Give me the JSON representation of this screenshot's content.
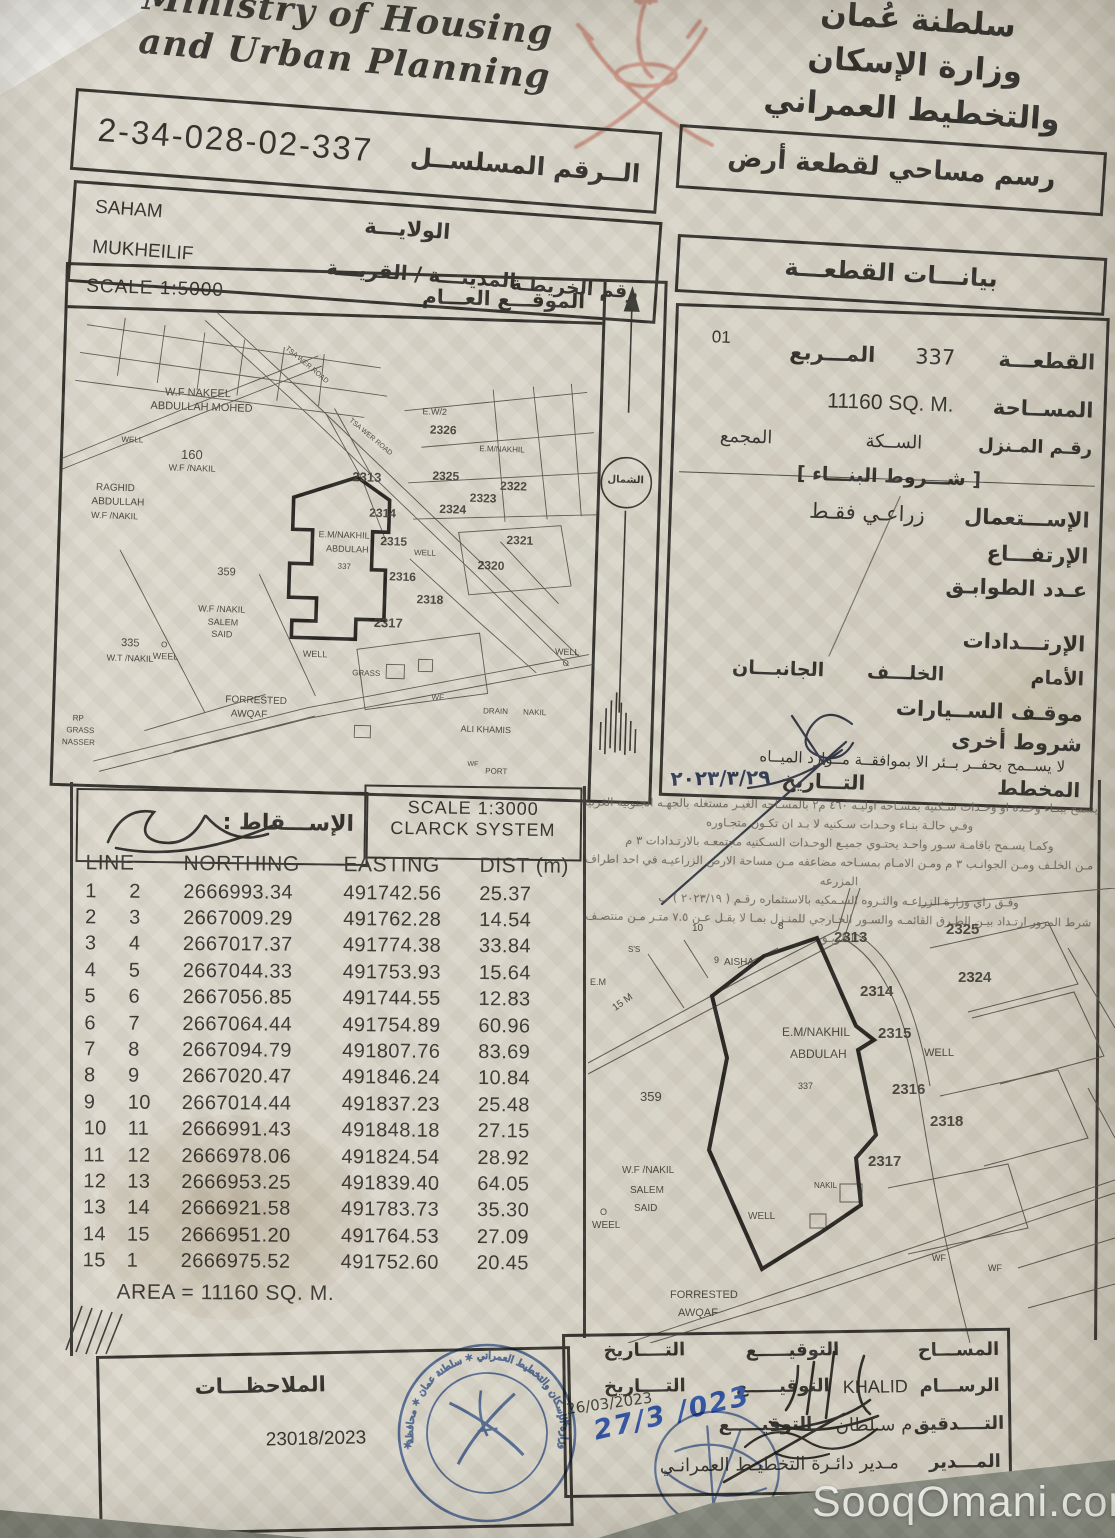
{
  "header": {
    "ministry_en_line1": "Ministry of Housing",
    "ministry_en_line2": "and Urban Planning",
    "ministry_ar_lines": [
      "سلطنة عُمان",
      "وزارة الإسكان",
      "والتخطيط العمراني"
    ],
    "serial_number": "2-34-028-02-337",
    "serial_label": "الــرقم المسلســل"
  },
  "location": {
    "wilayat_value": "SAHAM",
    "wilayat_label": "الولايـــة",
    "town_value": "MUKHEILIF",
    "town_label": "المدينـــة / القريـــة",
    "map_no_label": "رقم الخريطـة"
  },
  "survey_title": "رسم مساحي لقطعة أرض",
  "plot_info_title": "بيانـــات القطعـــة",
  "map1": {
    "scale_label": "SCALE 1:5000",
    "location_label": "الموقـــع العـــام",
    "north_label": "الشمال",
    "labels": [
      {
        "t": "W.F NAKEEL",
        "x": 100,
        "y": 76,
        "s": 11
      },
      {
        "t": "ABDULLAH MOHED",
        "x": 86,
        "y": 90,
        "s": 11
      },
      {
        "t": "WELL",
        "x": 58,
        "y": 126,
        "s": 8
      },
      {
        "t": "160",
        "x": 118,
        "y": 136,
        "s": 13
      },
      {
        "t": "W.F /NAKIL",
        "x": 106,
        "y": 152,
        "s": 9
      },
      {
        "t": "RAGHID",
        "x": 34,
        "y": 174,
        "s": 10
      },
      {
        "t": "ABDULLAH",
        "x": 30,
        "y": 188,
        "s": 10
      },
      {
        "t": "W.F /NAKIL",
        "x": 30,
        "y": 202,
        "s": 9
      },
      {
        "t": "359",
        "x": 158,
        "y": 254,
        "s": 11
      },
      {
        "t": "TSA WER ROAD",
        "x": 214,
        "y": 46,
        "s": 7,
        "r": 38
      },
      {
        "t": "TSA WER ROAD",
        "x": 280,
        "y": 116,
        "s": 7,
        "r": 38
      },
      {
        "t": "E.W/2",
        "x": 358,
        "y": 88,
        "s": 9
      },
      {
        "t": "2326",
        "x": 366,
        "y": 104,
        "s": 12,
        "b": 1
      },
      {
        "t": "E.M/NAKHIL",
        "x": 416,
        "y": 124,
        "s": 8
      },
      {
        "t": "2313",
        "x": 290,
        "y": 153,
        "s": 13,
        "b": 1
      },
      {
        "t": "2325",
        "x": 370,
        "y": 150,
        "s": 12,
        "b": 1
      },
      {
        "t": "2322",
        "x": 438,
        "y": 158,
        "s": 12,
        "b": 1
      },
      {
        "t": "2323",
        "x": 408,
        "y": 171,
        "s": 12,
        "b": 1
      },
      {
        "t": "2324",
        "x": 378,
        "y": 183,
        "s": 12,
        "b": 1
      },
      {
        "t": "2314",
        "x": 308,
        "y": 189,
        "s": 12,
        "b": 1
      },
      {
        "t": "2315",
        "x": 320,
        "y": 217,
        "s": 12,
        "b": 1
      },
      {
        "t": "E.M/NAKHIL",
        "x": 258,
        "y": 214,
        "s": 9
      },
      {
        "t": "ABDULAH",
        "x": 266,
        "y": 228,
        "s": 9
      },
      {
        "t": "337",
        "x": 278,
        "y": 246,
        "s": 8
      },
      {
        "t": "WELL",
        "x": 354,
        "y": 230,
        "s": 8
      },
      {
        "t": "2320",
        "x": 418,
        "y": 238,
        "s": 12,
        "b": 1
      },
      {
        "t": "2321",
        "x": 446,
        "y": 212,
        "s": 12,
        "b": 1
      },
      {
        "t": "2316",
        "x": 330,
        "y": 252,
        "s": 12,
        "b": 1
      },
      {
        "t": "2318",
        "x": 358,
        "y": 274,
        "s": 12,
        "b": 1
      },
      {
        "t": "2317",
        "x": 316,
        "y": 298,
        "s": 13,
        "b": 1
      },
      {
        "t": "W.F /NAKIL",
        "x": 140,
        "y": 292,
        "s": 9
      },
      {
        "t": "SALEM",
        "x": 150,
        "y": 305,
        "s": 9
      },
      {
        "t": "SAID",
        "x": 154,
        "y": 317,
        "s": 9
      },
      {
        "t": "335",
        "x": 64,
        "y": 328,
        "s": 11
      },
      {
        "t": "W.T /NAKIL",
        "x": 50,
        "y": 344,
        "s": 9
      },
      {
        "t": "O",
        "x": 104,
        "y": 330,
        "s": 8
      },
      {
        "t": "WEEL",
        "x": 96,
        "y": 341,
        "s": 9
      },
      {
        "t": "WELL",
        "x": 246,
        "y": 334,
        "s": 9
      },
      {
        "t": "GRASS",
        "x": 296,
        "y": 352,
        "s": 8
      },
      {
        "t": "FORRESTED",
        "x": 170,
        "y": 382,
        "s": 10
      },
      {
        "t": "AWQAF",
        "x": 176,
        "y": 396,
        "s": 10
      },
      {
        "t": "RP",
        "x": 18,
        "y": 406,
        "s": 8
      },
      {
        "t": "GRASS",
        "x": 12,
        "y": 418,
        "s": 8
      },
      {
        "t": "NASSER",
        "x": 8,
        "y": 430,
        "s": 8
      },
      {
        "t": "ALI KHAMIS",
        "x": 406,
        "y": 404,
        "s": 9
      },
      {
        "t": "DRAIN",
        "x": 428,
        "y": 386,
        "s": 8
      },
      {
        "t": "WF",
        "x": 376,
        "y": 374,
        "s": 8
      },
      {
        "t": "NAKIL",
        "x": 468,
        "y": 386,
        "s": 8
      },
      {
        "t": "WELL",
        "x": 498,
        "y": 324,
        "s": 9
      },
      {
        "t": "O",
        "x": 506,
        "y": 336,
        "s": 8
      },
      {
        "t": "WF",
        "x": 414,
        "y": 440,
        "s": 7
      },
      {
        "t": "PORT",
        "x": 432,
        "y": 446,
        "s": 8
      }
    ]
  },
  "plot": {
    "page_code": "01",
    "plot_label": "القطعـــة",
    "plot_no": "337",
    "square_label": "المـــربع",
    "area_label": "المســاحة",
    "area_value": "11160 SQ. M.",
    "house_no_label": "رقـم المـنزل",
    "street_label": "الســكة",
    "complex_label": "المجمع",
    "building_conditions_label": "شـــروط البنـــاء",
    "use_label": "الإســـتعمال",
    "use_value": "زراعـي فقـط",
    "height_label": "الإرتفـــاع",
    "floors_label": "عـدد الطوابـق",
    "setbacks_label": "الإرتـــدادات",
    "front_label": "الأمام",
    "back_label": "الخلـــف",
    "sides_label": "الجانبـــان",
    "parking_label": "موقـف الســيارات",
    "other_conditions_label": "شروط أخرى",
    "other_conditions_value": "لا يســمح بحفــر بــئر الا بموافقــة مــوارد الميــاه",
    "planner_label": "المخطط",
    "date_label": "التـــاريخ",
    "planner_date": "٢٠٢٣/٣/٢٩"
  },
  "projection": {
    "label": "الإســـقاط :",
    "scale_line1": "SCALE 1:3000",
    "scale_line2": "CLARCK SYSTEM"
  },
  "conditions_lines": [
    "يسمح ببنـاء وحـده او وحـدات سـكنيه بمسـاحه اوليـه ٤٦٠ م٢ بالمسـاحه الغيـر مستغله بالجهـه الجنوبيه الغربيه",
    "وفـي حالـة بنـاء وحـدات سـكنيه لا بـد ان تكـون متجـاوره",
    "وكمـا يسـمح باقامـة سـور واحـد يحتـوي جميـع الوحـدات السـكنيه مجتمعـه بالارتـدادات ٣ م",
    "مـن الخلـف ومـن الجوانـب ٣ م ومـن الامـام بمسـاحه مضاعفه مـن مساحة الارض الزراعيـه في احد اطراف المزرعه",
    "وفـق راي وزارة الزراعـه والثـروه السـمكيه بالاستثماره رقـم ( ٢٠٢٣/١٩ ) ب",
    "شرط المرور ارتـداد بيـن الطـرق القائمـه والسـور الخـارجي للمنـزل بمـا لا يقـل عـن ٧.٥ متـر مـن منتصـف الطريـق"
  ],
  "coords_table": {
    "headers": [
      "LINE",
      "NORTHING",
      "EASTING",
      "DIST (m)"
    ],
    "rows": [
      [
        "1",
        "2",
        "2666993.34",
        "491742.56",
        "25.37"
      ],
      [
        "2",
        "3",
        "2667009.29",
        "491762.28",
        "14.54"
      ],
      [
        "3",
        "4",
        "2667017.37",
        "491774.38",
        "33.84"
      ],
      [
        "4",
        "5",
        "2667044.33",
        "491753.93",
        "15.64"
      ],
      [
        "5",
        "6",
        "2667056.85",
        "491744.55",
        "12.83"
      ],
      [
        "6",
        "7",
        "2667064.44",
        "491754.89",
        "60.96"
      ],
      [
        "7",
        "8",
        "2667094.79",
        "491807.76",
        "83.69"
      ],
      [
        "8",
        "9",
        "2667020.47",
        "491846.24",
        "10.84"
      ],
      [
        "9",
        "10",
        "2667014.44",
        "491837.23",
        "25.48"
      ],
      [
        "10",
        "11",
        "2666991.43",
        "491848.18",
        "27.15"
      ],
      [
        "11",
        "12",
        "2666978.06",
        "491824.54",
        "28.92"
      ],
      [
        "12",
        "13",
        "2666953.25",
        "491839.40",
        "64.05"
      ],
      [
        "13",
        "14",
        "2666921.58",
        "491783.73",
        "35.30"
      ],
      [
        "14",
        "15",
        "2666951.20",
        "491764.53",
        "27.09"
      ],
      [
        "15",
        "1",
        "2666975.52",
        "491752.60",
        "20.45"
      ]
    ],
    "area_note": "AREA = 11160 SQ. M."
  },
  "map2": {
    "labels": [
      {
        "t": "10",
        "x": 104,
        "y": 36,
        "s": 10
      },
      {
        "t": "8",
        "x": 190,
        "y": 34,
        "s": 10
      },
      {
        "t": "2313",
        "x": 246,
        "y": 42,
        "s": 15,
        "b": 1
      },
      {
        "t": "2325",
        "x": 358,
        "y": 34,
        "s": 15,
        "b": 1
      },
      {
        "t": "2324",
        "x": 370,
        "y": 82,
        "s": 15,
        "b": 1
      },
      {
        "t": "2314",
        "x": 272,
        "y": 96,
        "s": 15,
        "b": 1
      },
      {
        "t": "2315",
        "x": 290,
        "y": 138,
        "s": 15,
        "b": 1
      },
      {
        "t": "WELL",
        "x": 336,
        "y": 160,
        "s": 11
      },
      {
        "t": "2316",
        "x": 304,
        "y": 194,
        "s": 15,
        "b": 1
      },
      {
        "t": "2318",
        "x": 342,
        "y": 226,
        "s": 15,
        "b": 1
      },
      {
        "t": "2317",
        "x": 280,
        "y": 266,
        "s": 15,
        "b": 1
      },
      {
        "t": "E.M/NAKHIL",
        "x": 194,
        "y": 138,
        "s": 12
      },
      {
        "t": "ABDULAH",
        "x": 202,
        "y": 160,
        "s": 12
      },
      {
        "t": "337",
        "x": 210,
        "y": 194,
        "s": 9
      },
      {
        "t": "359",
        "x": 52,
        "y": 202,
        "s": 13
      },
      {
        "t": "9",
        "x": 126,
        "y": 68,
        "s": 9
      },
      {
        "t": "AISHA",
        "x": 136,
        "y": 70,
        "s": 10
      },
      {
        "t": "S'S",
        "x": 40,
        "y": 58,
        "s": 8
      },
      {
        "t": "15 M",
        "x": 24,
        "y": 110,
        "s": 10,
        "r": -36
      },
      {
        "t": "E.M",
        "x": 2,
        "y": 90,
        "s": 9
      },
      {
        "t": "W.F /NAKIL",
        "x": 34,
        "y": 278,
        "s": 10
      },
      {
        "t": "SALEM",
        "x": 42,
        "y": 298,
        "s": 10
      },
      {
        "t": "SAID",
        "x": 46,
        "y": 316,
        "s": 10
      },
      {
        "t": "O",
        "x": 12,
        "y": 320,
        "s": 9
      },
      {
        "t": "WEEL",
        "x": 4,
        "y": 333,
        "s": 10
      },
      {
        "t": "WELL",
        "x": 160,
        "y": 324,
        "s": 10
      },
      {
        "t": "NAKIL",
        "x": 226,
        "y": 294,
        "s": 8
      },
      {
        "t": "FORRESTED",
        "x": 82,
        "y": 402,
        "s": 11
      },
      {
        "t": "AWQAF",
        "x": 90,
        "y": 420,
        "s": 11
      },
      {
        "t": "WF",
        "x": 344,
        "y": 366,
        "s": 9
      },
      {
        "t": "WF",
        "x": 400,
        "y": 376,
        "s": 9
      }
    ]
  },
  "footer": {
    "notes_label": "الملاحظـــات",
    "reference_number": "23018/2023",
    "surveyor_label": "المســـاح",
    "signature_label": "التوقيـــــع",
    "date_label": "التــــاريخ",
    "draftsman_label": "الرســـام",
    "draftsman_name": "KHALID",
    "draftsman_date": "26/03/2023",
    "audit_label": "التــــدقيق",
    "audit_name": "م سـلطان",
    "manager_label": "المـــدير",
    "manager_title": "مـدير دائـرة التخطيـط العمرانـي",
    "handwritten_date": "27/3 /023"
  },
  "watermark": "SooqOmani.com"
}
